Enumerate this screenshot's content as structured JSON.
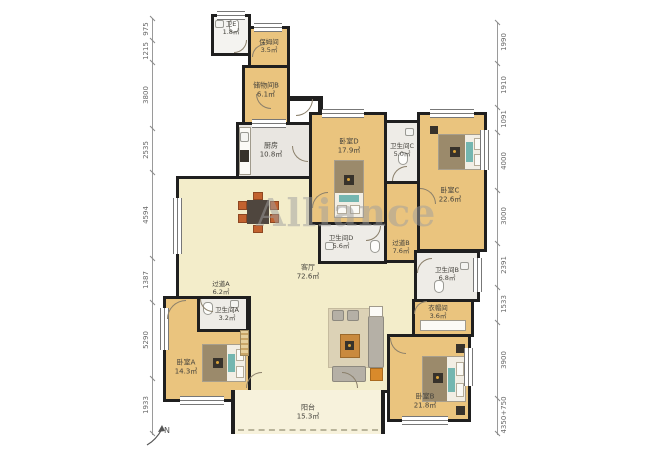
{
  "watermark": "Alliance",
  "compass": {
    "label": "N"
  },
  "rooms": {
    "weiE": {
      "name": "卫E",
      "area": "1.8㎡"
    },
    "nanny": {
      "name": "保姆间",
      "area": "3.5㎡"
    },
    "storageB": {
      "name": "储物间B",
      "area": "6.1㎡"
    },
    "kitchen": {
      "name": "厨房",
      "area": "10.8㎡"
    },
    "bedD": {
      "name": "卧室D",
      "area": "17.9㎡"
    },
    "bathC": {
      "name": "卫生间C",
      "area": "5.0㎡"
    },
    "bedC": {
      "name": "卧室C",
      "area": "22.6㎡"
    },
    "bathD": {
      "name": "卫生间D",
      "area": "5.6㎡"
    },
    "hallB": {
      "name": "过道B",
      "area": "7.6㎡"
    },
    "bathB": {
      "name": "卫生间B",
      "area": "6.8㎡"
    },
    "living": {
      "name": "客厅",
      "area": "72.6㎡"
    },
    "cloak": {
      "name": "衣帽间",
      "area": "3.6㎡"
    },
    "hallA": {
      "name": "过道A",
      "area": "6.2㎡"
    },
    "bathA": {
      "name": "卫生间A",
      "area": "3.2㎡"
    },
    "bedA": {
      "name": "卧室A",
      "area": "14.3㎡"
    },
    "bedB": {
      "name": "卧室B",
      "area": "21.8㎡"
    },
    "balcony": {
      "name": "阳台",
      "area": "15.3㎡"
    }
  },
  "dims": {
    "left": [
      "975",
      "1215",
      "3800",
      "2535",
      "4594",
      "1387",
      "5290",
      "1933"
    ],
    "right": [
      "1990",
      "1910",
      "1091",
      "4000",
      "3000",
      "2391",
      "1533",
      "3900",
      "4350+750"
    ]
  },
  "colors": {
    "wall": "#1f1f1f",
    "wood_floor": "#eac47e",
    "living_floor": "#f3edca",
    "tile_floor": "#eeece7",
    "balcony_floor": "#f7f2dc",
    "accent_teal": "#74b6b0",
    "accent_orange": "#d98a2b"
  }
}
